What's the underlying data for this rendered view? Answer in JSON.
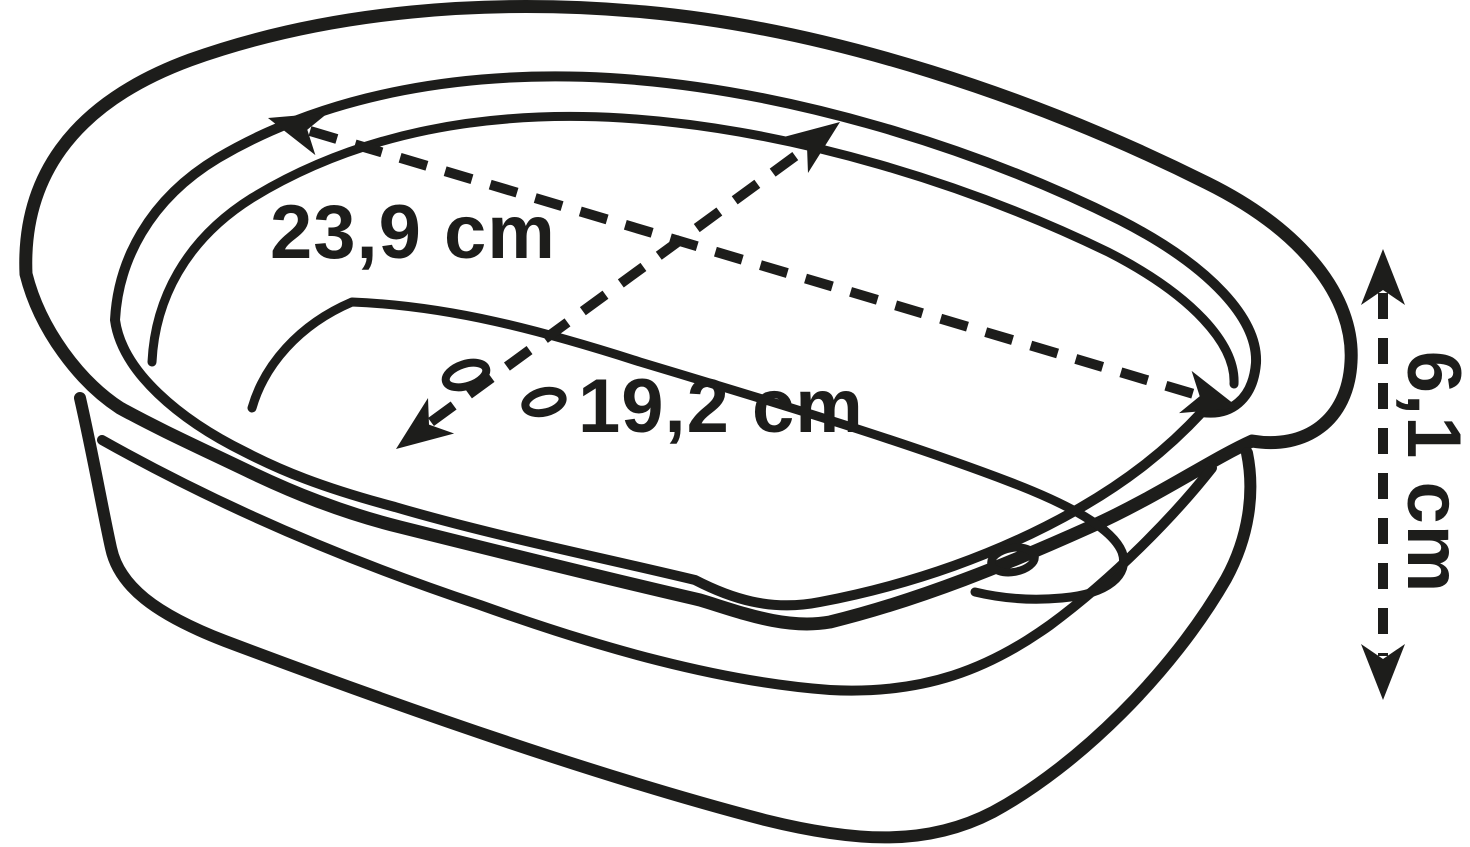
{
  "diagram": {
    "title": "tray-dimension-diagram",
    "colors": {
      "line": "#1d1d1b",
      "background": "#ffffff"
    },
    "dimensions": {
      "width": {
        "label": "23,9 cm",
        "value": "23,9",
        "unit": "cm"
      },
      "depth": {
        "label": "19,2 cm",
        "value": "19,2",
        "unit": "cm"
      },
      "height": {
        "label": "6,1 cm",
        "value": "6,1",
        "unit": "cm"
      }
    },
    "features": {
      "drainage_hole_count": 3
    }
  }
}
